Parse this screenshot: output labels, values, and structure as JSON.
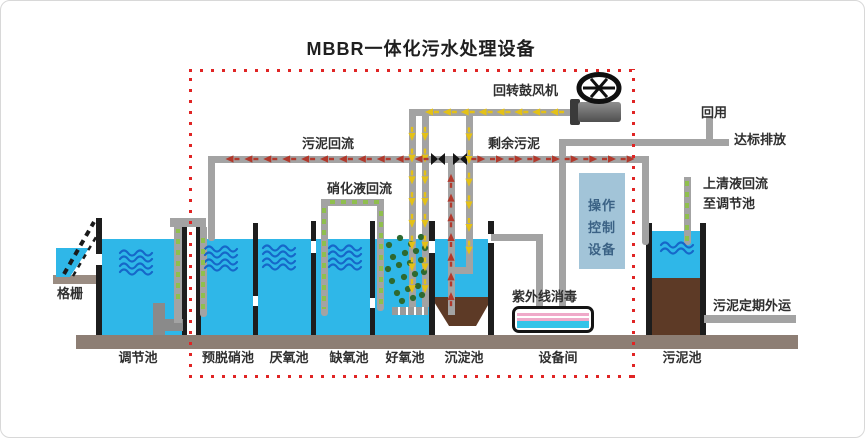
{
  "title": "MBBR一体化污水处理设备",
  "diagram": {
    "labels": {
      "grid": "格栅",
      "blower": "回转鼓风机",
      "sludge_return": "污泥回流",
      "nitrified_recycle": "硝化液回流",
      "excess_sludge": "剩余污泥",
      "reuse": "回用",
      "discharge": "达标排放",
      "supernatant_return_1": "上清液回流",
      "supernatant_return_2": "至调节池",
      "uv_disinfection": "紫外线消毒",
      "sludge_removal": "污泥定期外运"
    },
    "control_unit": {
      "line1": "操作",
      "line2": "控制",
      "line3": "设备"
    },
    "tank_labels": [
      "调节池",
      "预脱硝池",
      "厌氧池",
      "缺氧池",
      "好氧池",
      "沉淀池",
      "设备间",
      "污泥池"
    ]
  },
  "colors": {
    "water": "#2fb7e8",
    "sludge": "#5d3a26",
    "pipe": "#a3a3a3",
    "wall": "#1d1d1d",
    "air_arrow": "#e4c117",
    "sludge_arrow": "#b2392c",
    "recycle_dash": "#8fbf4d",
    "boundary": "#e02424",
    "control_box": "#a2c4d8",
    "uv_pink": "#efa9c9",
    "base": "#8d7e74",
    "wave": "#1667c9",
    "media_dot": "#2e6930"
  }
}
